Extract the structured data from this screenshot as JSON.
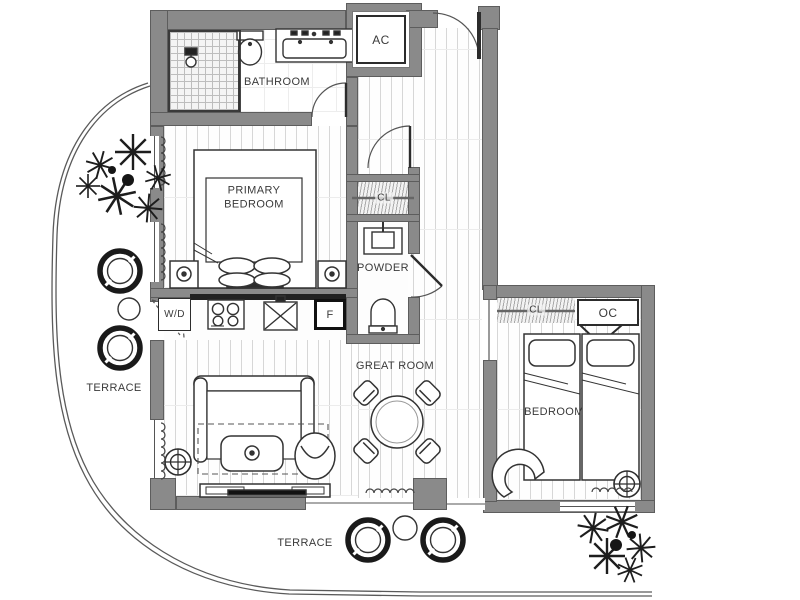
{
  "plan": {
    "title": "apartment-floor-plan",
    "rooms": {
      "bathroom": "BATHROOM",
      "ac_closet": "AC",
      "primary_bedroom": "PRIMARY BEDROOM",
      "primary_closet": "CL",
      "powder": "POWDER",
      "washer_dryer": "W/D",
      "fridge": "F",
      "great_room": "GREAT ROOM",
      "bedroom_closet": "CL",
      "owners_closet": "OC",
      "bedroom": "BEDROOM",
      "terrace_left": "TERRACE",
      "terrace_bottom": "TERRACE"
    },
    "colors": {
      "wall": "#8a8a8a",
      "wall_edge": "#5d5d5d",
      "line": "#333333",
      "floor_line": "#d7d7d7",
      "background": "#ffffff",
      "counter_dark": "#222222"
    }
  }
}
